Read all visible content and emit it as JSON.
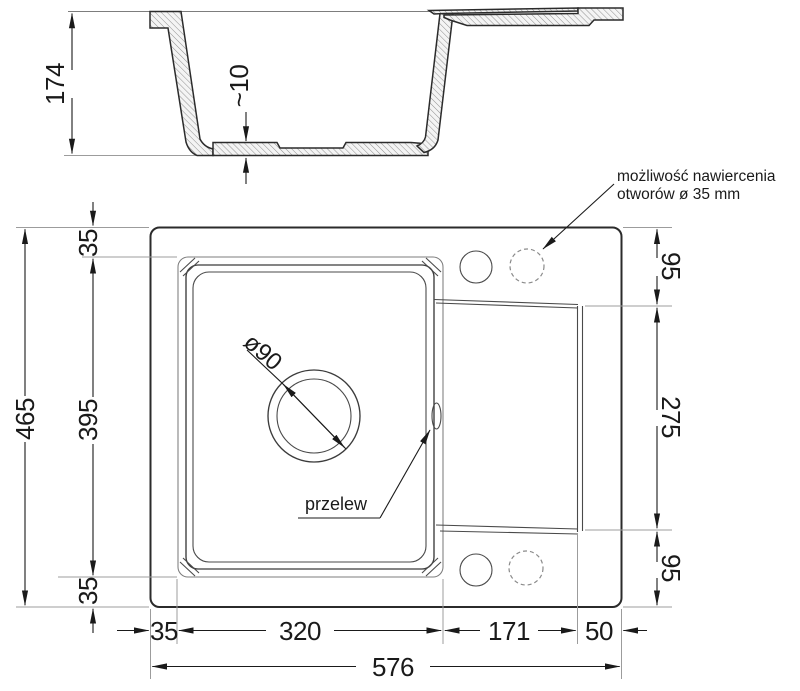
{
  "drawing": {
    "type": "sink technical drawing",
    "ink_color": "#1a1a1a",
    "line_color": "#2b2b2b",
    "extension_line_color": "#9c9c9c"
  },
  "cross_section": {
    "height": "174",
    "base_thickness": "~10"
  },
  "plan": {
    "left": {
      "offset_top": "35",
      "bowl_length": "395",
      "offset_bottom": "35",
      "total": "465"
    },
    "right": {
      "top": "95",
      "middle": "275",
      "bottom": "95"
    },
    "bottom": {
      "offset_left": "35",
      "bowl_width": "320",
      "drainer": "171",
      "edge": "50",
      "total": "576"
    },
    "drain_label": "ø90",
    "overflow_label": "przelew",
    "note": {
      "line1": "możliwość nawiercenia",
      "line2": "otworów ø 35 mm"
    }
  }
}
